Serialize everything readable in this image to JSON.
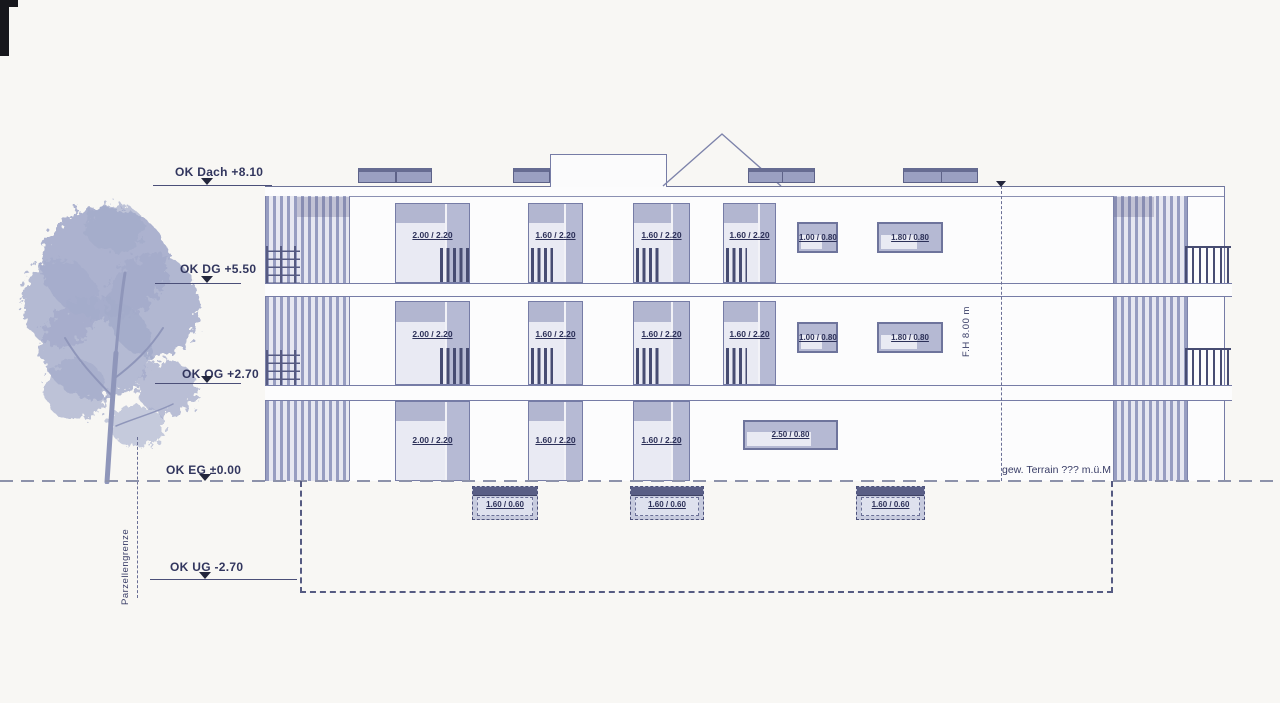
{
  "levels": [
    {
      "label": "OK Dach +8.10"
    },
    {
      "label": "OK DG +5.50"
    },
    {
      "label": "OK OG +2.70"
    },
    {
      "label": "OK EG ±0.00"
    },
    {
      "label": "OK UG -2.70"
    }
  ],
  "annotations": {
    "parcel_boundary": "Parzellengrenze",
    "facade_height": "F.H 8.00 m",
    "terrain_note": "gew. Terrain ??? m.ü.M"
  },
  "floors": {
    "attic": {
      "windows": [
        "2.00 / 2.20",
        "1.60 / 2.20",
        "1.60 / 2.20",
        "1.60 / 2.20",
        "1.00 / 0.80",
        "1.80 / 0.80"
      ]
    },
    "upper": {
      "windows": [
        "2.00 / 2.20",
        "1.60 / 2.20",
        "1.60 / 2.20",
        "1.60 / 2.20",
        "1.00 / 0.80",
        "1.80 / 0.80"
      ]
    },
    "ground": {
      "windows": [
        "2.00 / 2.20",
        "1.60 / 2.20",
        "1.60 / 2.20",
        "2.50 / 0.80"
      ]
    },
    "basement": {
      "windows": [
        "1.60 / 0.60",
        "1.60 / 0.60",
        "1.60 / 0.60"
      ]
    }
  },
  "colors": {
    "line": "#767ca6",
    "ink": "#2c3058",
    "glass": "#e9eaf3",
    "frame": "#b5b9d3",
    "railing": "#474c72",
    "background": "#f8f7f4"
  }
}
